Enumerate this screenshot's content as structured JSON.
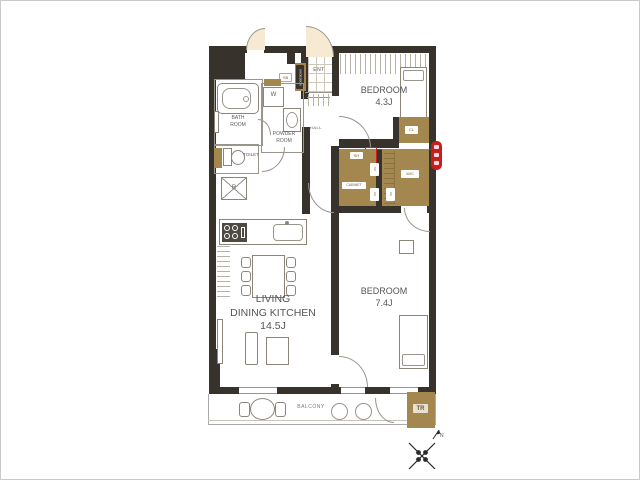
{
  "plan": {
    "labels": {
      "bedroom1_name": "BEDROOM",
      "bedroom1_size": "4.3J",
      "bedroom2_name": "BEDROOM",
      "bedroom2_size": "7.4J",
      "ldk_line1": "LIVING",
      "ldk_line2": "DINING KITCHEN",
      "ldk_line3": "14.5J",
      "bath_line1": "BATH",
      "bath_line2": "ROOM",
      "powder_line1": "POWDER",
      "powder_line2": "ROOM",
      "toilet": "TOILET",
      "ent": "ENT",
      "hall": "HALL",
      "balcony": "BALCONY",
      "washer": "W",
      "fridge": "R",
      "wic": "WIC",
      "closet": "CL",
      "shelf": "SH",
      "cabinet": "CABINET",
      "shoes_box": "SHOESBOX",
      "meter": "SB",
      "trunk_room": "TR",
      "north": "N"
    },
    "colors": {
      "wall": "#37322c",
      "closet_fill": "#a3874f",
      "door_swing": "#f6ead3",
      "accent_red": "#c81e1e"
    }
  }
}
